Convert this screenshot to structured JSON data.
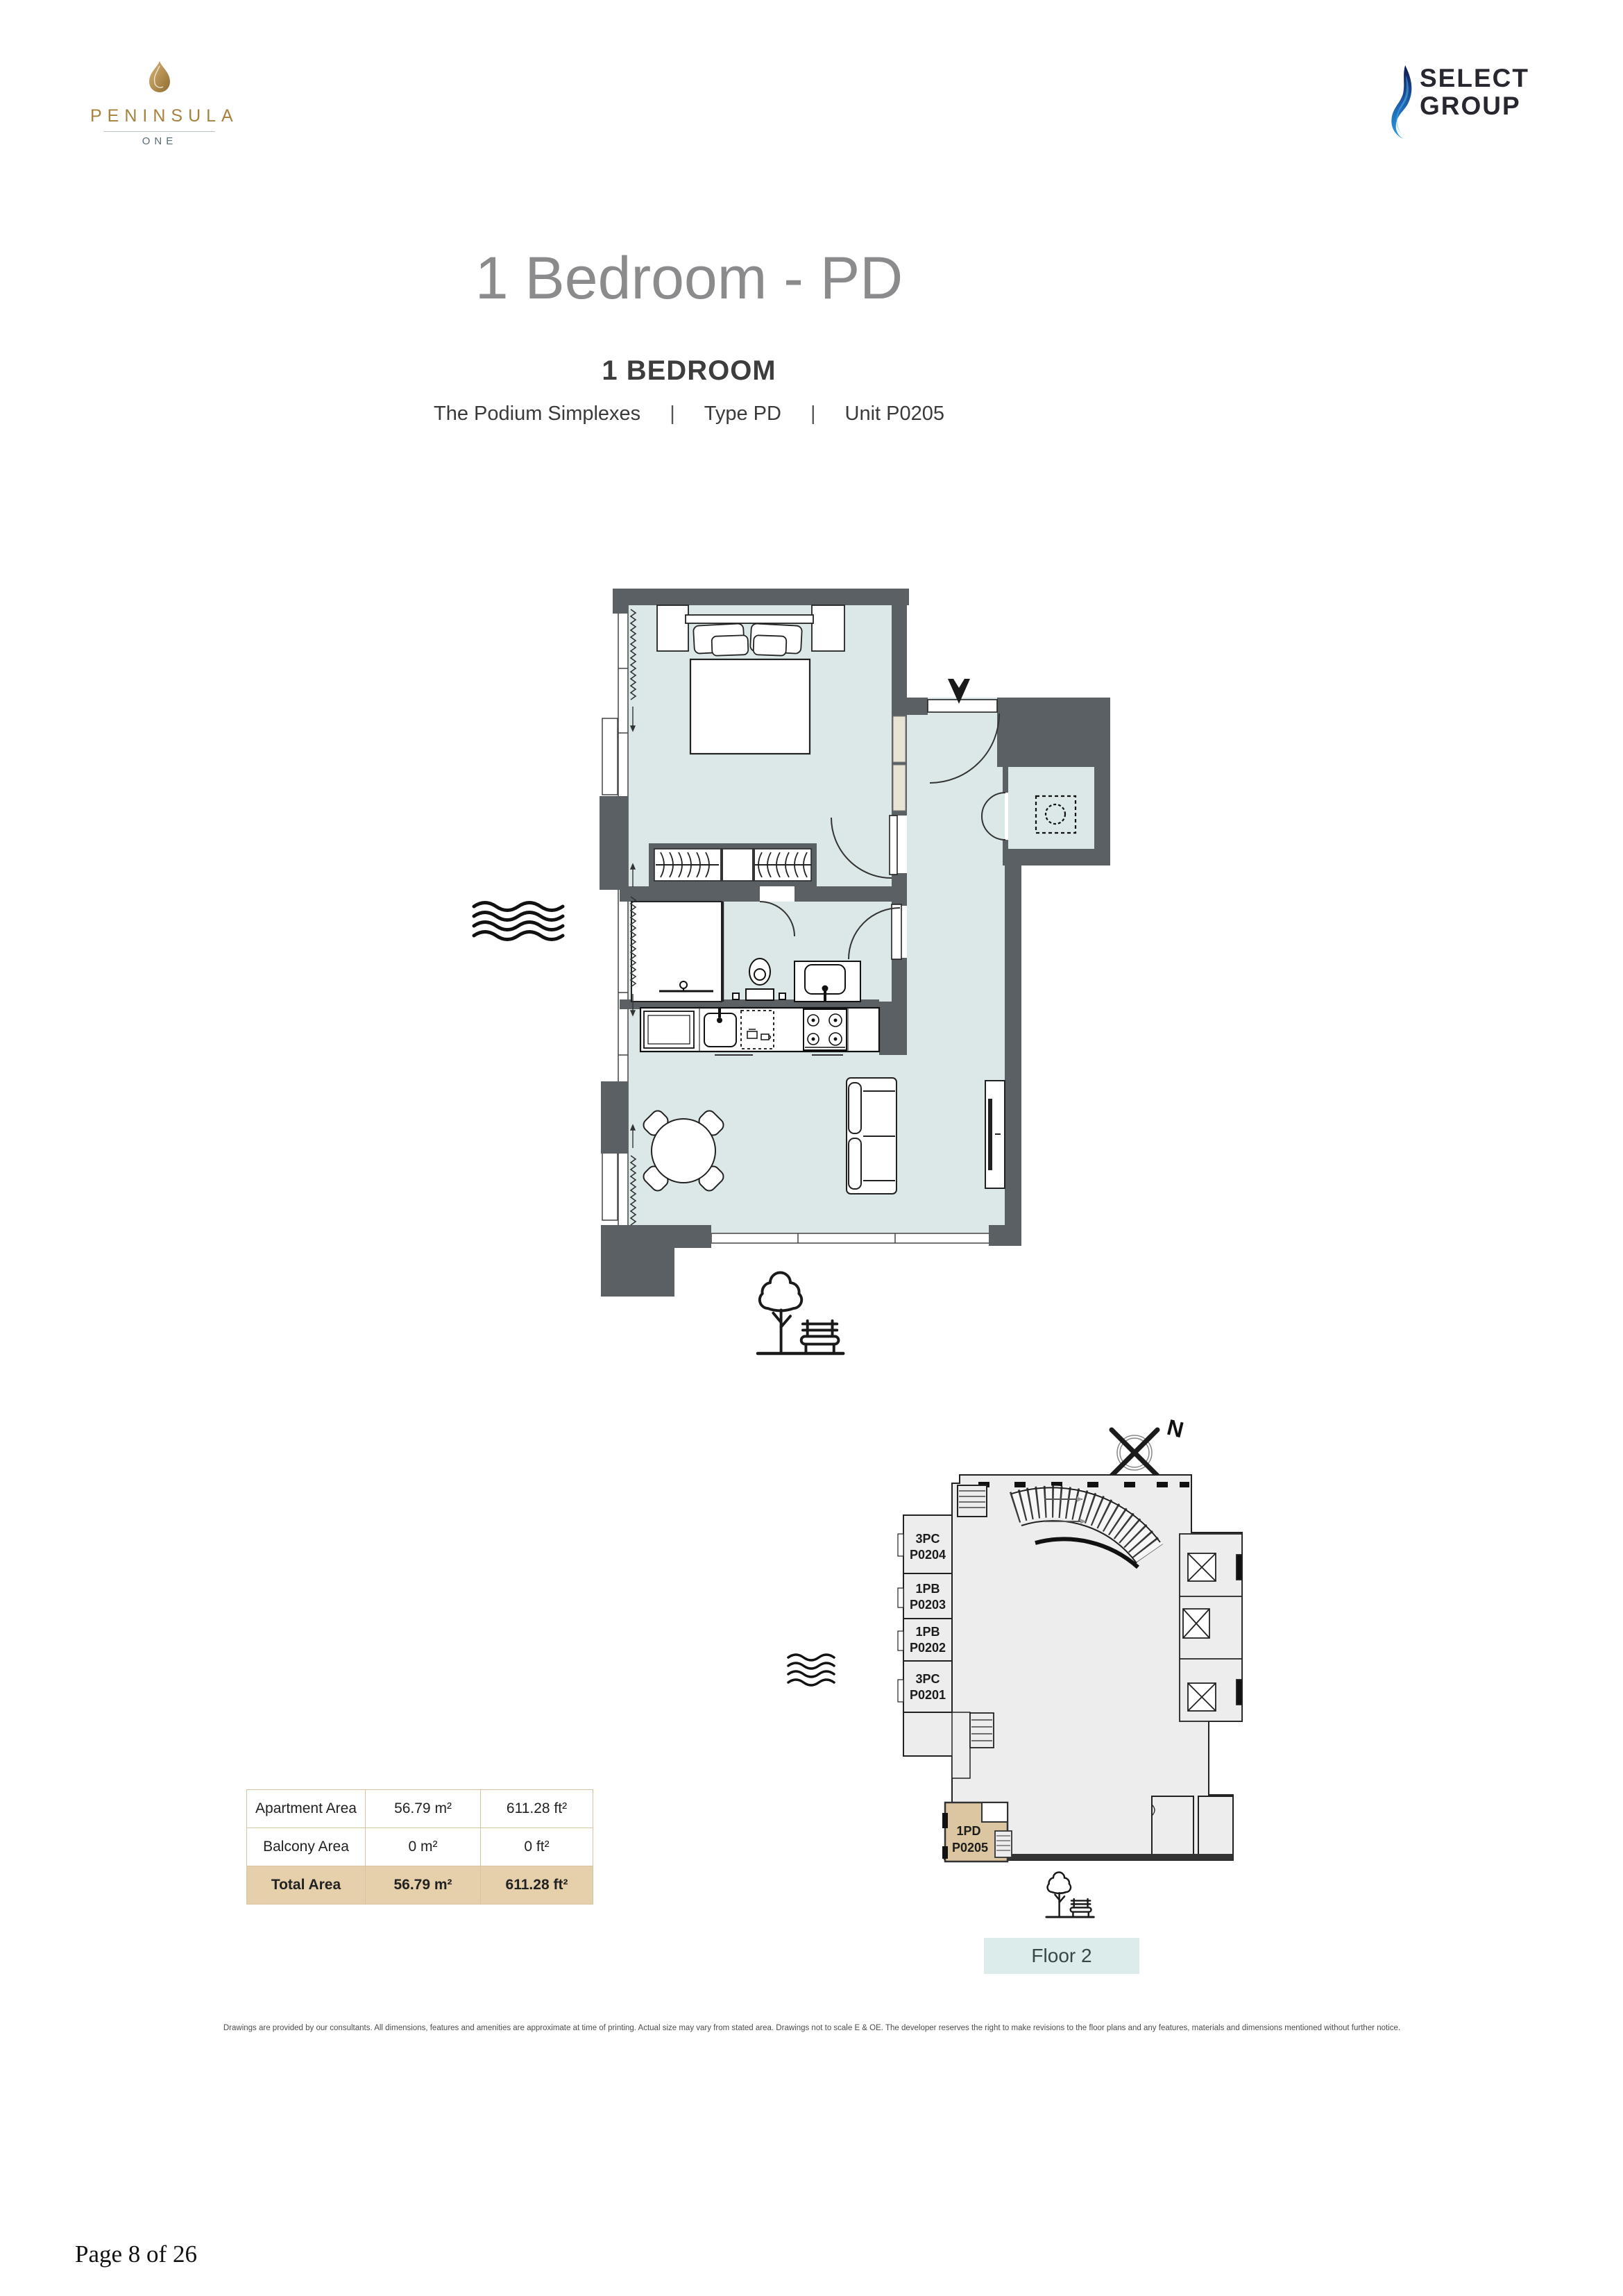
{
  "header": {
    "peninsula": {
      "name": "PENINSULA",
      "sub": "ONE"
    },
    "select": {
      "line1": "SELECT",
      "line2": "GROUP"
    }
  },
  "title": "1 Bedroom - PD",
  "subtitle": {
    "heading": "1 BEDROOM",
    "collection": "The Podium Simplexes",
    "sep1": "|",
    "type_label": "Type PD",
    "sep2": "|",
    "unit_label": "Unit P0205"
  },
  "area_table": {
    "rows": [
      {
        "label": "Apartment Area",
        "m2": "56.79 m²",
        "ft2": "611.28 ft²"
      },
      {
        "label": "Balcony Area",
        "m2": "0 m²",
        "ft2": "0 ft²"
      },
      {
        "label": "Total Area",
        "m2": "56.79 m²",
        "ft2": "611.28 ft²"
      }
    ]
  },
  "locator": {
    "north_label": "N",
    "units": [
      {
        "type": "3PC",
        "code": "P0204"
      },
      {
        "type": "1PB",
        "code": "P0203"
      },
      {
        "type": "1PB",
        "code": "P0202"
      },
      {
        "type": "3PC",
        "code": "P0201"
      }
    ],
    "highlight": {
      "type": "1PD",
      "code": "P0205"
    },
    "floor_label": "Floor 2"
  },
  "disclaimer": "Drawings are provided by our consultants. All dimensions, features and amenities are approximate at time of printing.  Actual size may vary from stated area. Drawings not to scale E & OE. The developer reserves the right to make revisions to the floor plans and any features, materials and dimensions mentioned without further notice.",
  "page_label": "Page 8 of 26",
  "colors": {
    "wall": "#5b6064",
    "room_fill": "#dbe8e7",
    "highlight_tan": "#dcc5a1",
    "table_total_bg": "#e6d0ab",
    "floor_badge_bg": "#dcecea",
    "brand_gold": "#a8813e",
    "select_blue": "#2e9fe2"
  }
}
